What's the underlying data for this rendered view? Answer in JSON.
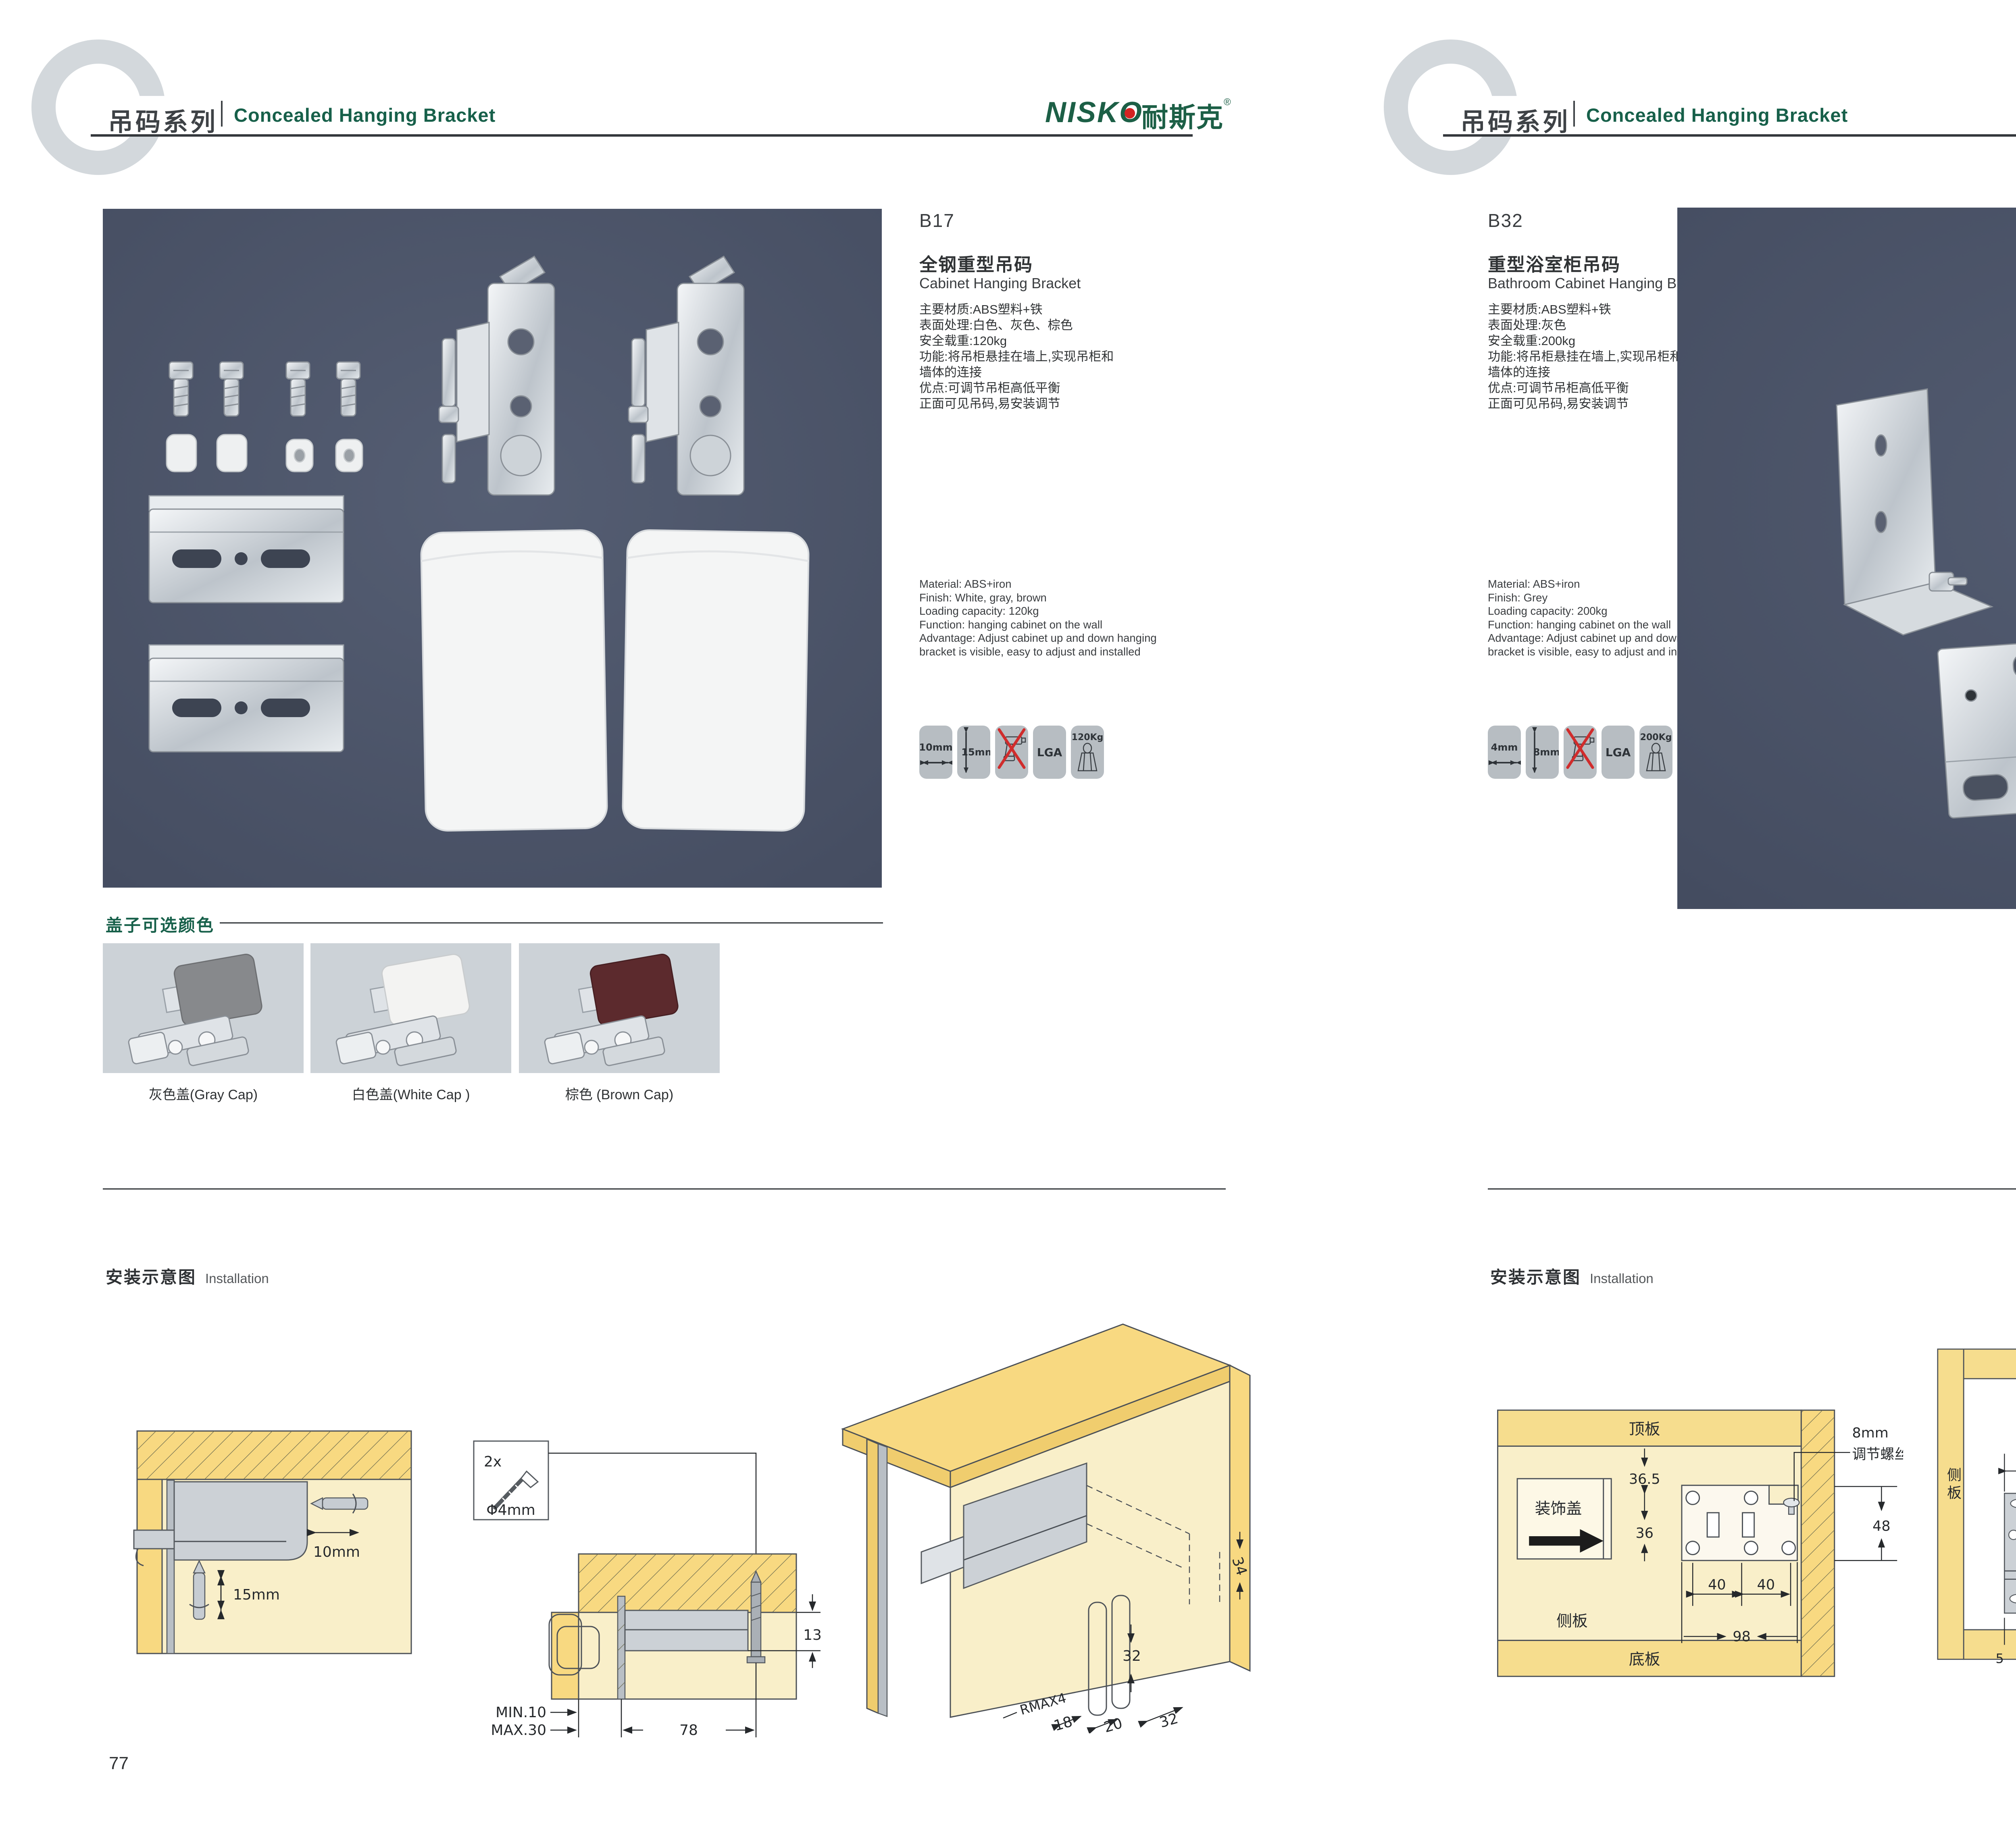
{
  "header": {
    "series_zh": "吊码系列",
    "series_en": "Concealed Hanging Bracket"
  },
  "brand": {
    "latin": "NISKO",
    "cjk": "耐斯克",
    "reg": "®"
  },
  "left_page": {
    "page_number": "77",
    "code": "B17",
    "title_zh": "全钢重型吊码",
    "title_en": "Cabinet Hanging Bracket",
    "specs_zh": [
      "主要材质:ABS塑料+铁",
      "表面处理:白色、灰色、棕色",
      "安全载重:120kg",
      "功能:将吊柜悬挂在墙上,实现吊柜和",
      "墙体的连接",
      "优点:可调节吊柜高低平衡",
      "正面可见吊码,易安装调节"
    ],
    "specs_en": [
      "Material: ABS+iron",
      "Finish: White, gray, brown",
      "Loading capacity: 120kg",
      "Function: hanging cabinet on the wall",
      "Advantage: Adjust cabinet up and down hanging",
      "bracket is visible, easy to adjust and installed"
    ],
    "icons": {
      "w": "10mm",
      "h": "15mm",
      "lga": "LGA",
      "load": "120Kg"
    },
    "caps_heading": "盖子可选颜色",
    "caps": [
      {
        "label": "灰色盖(Gray Cap)",
        "color": "#87898c"
      },
      {
        "label": "白色盖(White Cap )",
        "color": "#f3f3f2"
      },
      {
        "label": "棕色 (Brown Cap)",
        "color": "#5c2a2d"
      }
    ],
    "install_zh": "安装示意图",
    "install_en": "Installation",
    "diag1": {
      "d10": "10mm",
      "d15": "15mm"
    },
    "diag2": {
      "count": "2x",
      "dia": "Φ4mm",
      "t13": "13",
      "min": "MIN.10",
      "max": "MAX.30",
      "w78": "78"
    },
    "diag3": {
      "d34": "34",
      "d32": "32",
      "rmax": "RMAX4",
      "d18": "18",
      "d20": "20",
      "d32b": "32"
    }
  },
  "right_page": {
    "page_number": "78",
    "code": "B32",
    "title_zh": "重型浴室柜吊码",
    "title_en": "Bathroom Cabinet Hanging Bracket",
    "specs_zh": [
      "主要材质:ABS塑料+铁",
      "表面处理:灰色",
      "安全载重:200kg",
      "功能:将吊柜悬挂在墙上,实现吊柜和",
      "墙体的连接",
      "优点:可调节吊柜高低平衡",
      "正面可见吊码,易安装调节"
    ],
    "specs_en": [
      "Material: ABS+iron",
      "Finish: Grey",
      "Loading capacity: 200kg",
      "Function: hanging cabinet on the wall",
      "Advantage: Adjust cabinet up and down hanging",
      "bracket is visible, easy to adjust and installed"
    ],
    "icons": {
      "w": "4mm",
      "h": "8mm",
      "lga": "LGA",
      "load": "200Kg"
    },
    "install_zh": "安装示意图",
    "install_en": "Installation",
    "diag1": {
      "top": "顶板",
      "bottom": "底板",
      "side": "侧板",
      "cover": "装饰盖",
      "d365": "36.5",
      "d36": "36",
      "d40a": "40",
      "d40b": "40",
      "d98": "98",
      "note1": "8mm",
      "note2": "调节螺丝",
      "d48": "48"
    },
    "diag2": {
      "top": "顶板",
      "bottom": "底板",
      "side_l": "侧板",
      "side_r": "侧板",
      "d48": "48",
      "d80": "80",
      "d5a": "5",
      "d5b": "5"
    },
    "diag3": {
      "d18": "18",
      "d35": "35",
      "d47": "47",
      "d24": "24"
    }
  }
}
